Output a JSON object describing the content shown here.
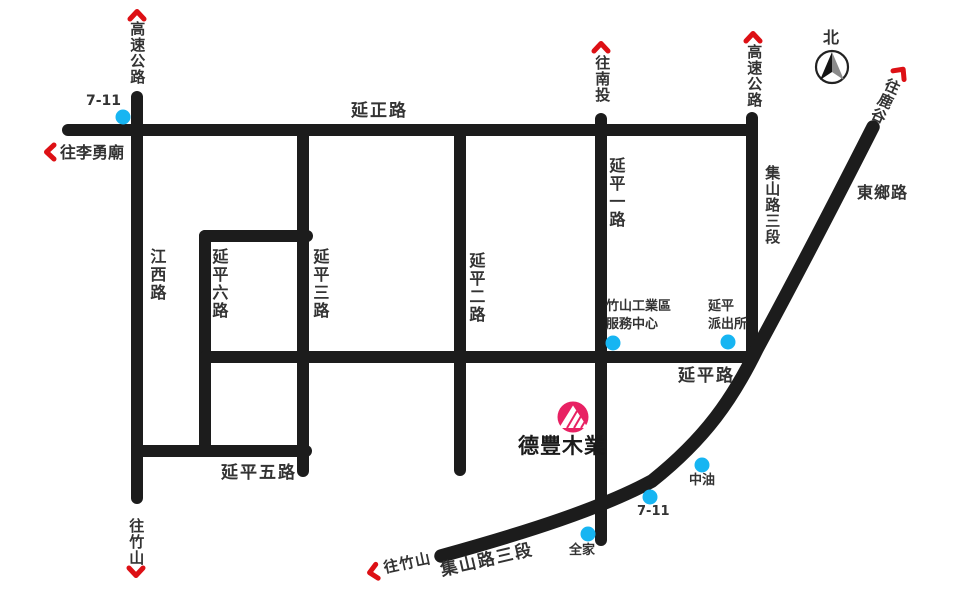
{
  "colors": {
    "road": "#1c1c1c",
    "label": "#333333",
    "arrow": "#dd1015",
    "poi": "#17b5f2",
    "brand": "#e82163"
  },
  "compass": {
    "north_label": "北"
  },
  "brand": {
    "name": "德豐木業"
  },
  "roads": {
    "yanzheng": "延正路",
    "jiangxi": "江西路",
    "yanping1": "延平一路",
    "yanping2": "延平二路",
    "yanping3": "延平三路",
    "yanping5": "延平五路",
    "yanping6": "延平六路",
    "yanping": "延平路",
    "jishan3_right": "集山路三段",
    "jishan3_bottom": "集山路三段",
    "dongxiang": "東鄉路",
    "highway_left": "高速公路",
    "highway_right": "高速公路"
  },
  "directions": {
    "to_nantou": "往南投",
    "to_lugu": "往鹿谷",
    "to_liyong_temple": "往李勇廟",
    "to_zhushan_left": "往竹山",
    "to_zhushan_bottom": "往竹山"
  },
  "pois": {
    "seven_eleven_top": "7-11",
    "seven_eleven_bottom": "7-11",
    "family_mart": "全家",
    "cpc": "中油",
    "service_center_line1": "竹山工業區",
    "service_center_line2": "服務中心",
    "police_line1": "延平",
    "police_line2": "派出所"
  }
}
